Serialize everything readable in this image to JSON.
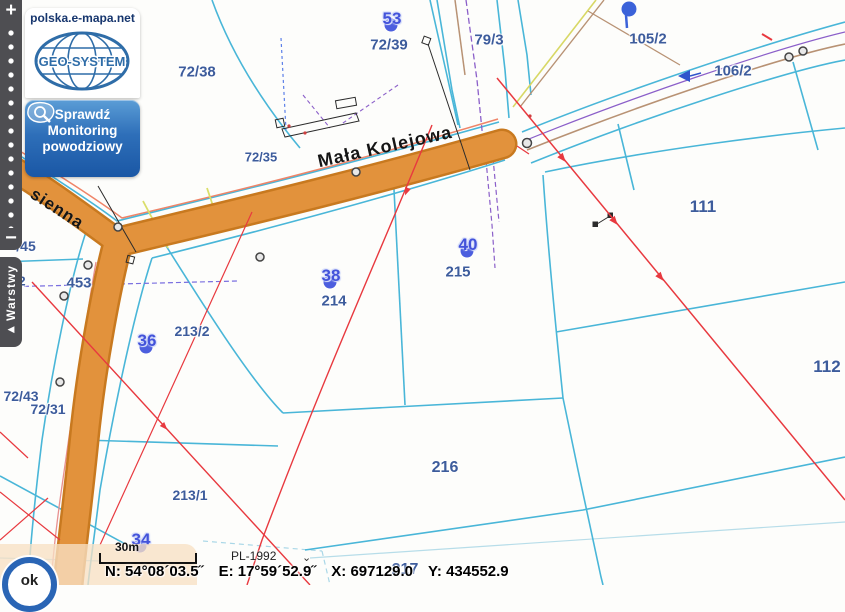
{
  "branding": {
    "site": "polska.e-mapa.net",
    "logo_text": "GEO-SYSTEM"
  },
  "flood_button": {
    "lines": [
      "Sprawdź",
      "Monitoring",
      "powodziowy"
    ]
  },
  "zoom_control": {
    "zoom_in": "+",
    "zoom_out": "−"
  },
  "layers_tab": {
    "label": "Warstwy",
    "collapse_icon": "◀"
  },
  "map": {
    "street_labels": [
      {
        "text": "Mała Kolejowa",
        "x": 385,
        "y": 147,
        "angle": -12.5,
        "size": 18
      },
      {
        "text": "sienna",
        "x": 57,
        "y": 209,
        "angle": 33,
        "size": 17
      }
    ],
    "parcels": [
      {
        "label": "72/38",
        "x": 197,
        "y": 72,
        "size": 15
      },
      {
        "label": "72/39",
        "x": 389,
        "y": 45,
        "size": 15
      },
      {
        "label": "79/3",
        "x": 489,
        "y": 40,
        "size": 15
      },
      {
        "label": "105/2",
        "x": 648,
        "y": 39,
        "size": 15
      },
      {
        "label": "106/2",
        "x": 733,
        "y": 71,
        "size": 15
      },
      {
        "label": "111",
        "x": 703,
        "y": 207,
        "size": 17
      },
      {
        "label": "112",
        "x": 827,
        "y": 367,
        "size": 17
      },
      {
        "label": "72/35",
        "x": 261,
        "y": 157,
        "size": 13
      },
      {
        "label": "453",
        "x": 79,
        "y": 283,
        "size": 15
      },
      {
        "label": "50/2",
        "x": 13,
        "y": 281,
        "size": 13
      },
      {
        "label": "/45",
        "x": 26,
        "y": 246,
        "size": 14
      },
      {
        "label": "213/2",
        "x": 192,
        "y": 331,
        "size": 14
      },
      {
        "label": "214",
        "x": 334,
        "y": 301,
        "size": 15
      },
      {
        "label": "215",
        "x": 458,
        "y": 272,
        "size": 15
      },
      {
        "label": "216",
        "x": 445,
        "y": 468,
        "size": 16
      },
      {
        "label": "217",
        "x": 405,
        "y": 570,
        "size": 16
      },
      {
        "label": "213/1",
        "x": 190,
        "y": 495,
        "size": 14
      },
      {
        "label": "72/43",
        "x": 21,
        "y": 396,
        "size": 14
      },
      {
        "label": "72/31",
        "x": 48,
        "y": 409,
        "size": 14
      }
    ],
    "address_markers": [
      {
        "num": "53",
        "x": 391,
        "y": 25
      },
      {
        "num": "38",
        "x": 330,
        "y": 282
      },
      {
        "num": "40",
        "x": 467,
        "y": 251
      },
      {
        "num": "36",
        "x": 146,
        "y": 347
      },
      {
        "num": "34",
        "x": 140,
        "y": 546
      }
    ]
  },
  "status_bar": {
    "ok_label": "ok",
    "scale_label": "30m",
    "crs_label": "PL-1992",
    "crs_chevron": "⌄",
    "coord_n": "N: 54°08´03.5˝",
    "coord_e": "E: 17°59´52.9˝",
    "coord_x": "X: 697129.0",
    "coord_y": "Y: 434552.9"
  },
  "colors": {
    "road_fill": "#e2923c",
    "road_edge": "#c8791f",
    "parcel_line": "#49b6d8",
    "label_blue": "#3d5c9c",
    "marker_blue": "#4c5ede",
    "measure_red": "#e8393f",
    "panel_dark": "#4e4e52",
    "button_blue_top": "#5b9dd6",
    "button_blue_bottom": "#1a57a5",
    "overlay_peach": "#f7e0c4"
  }
}
